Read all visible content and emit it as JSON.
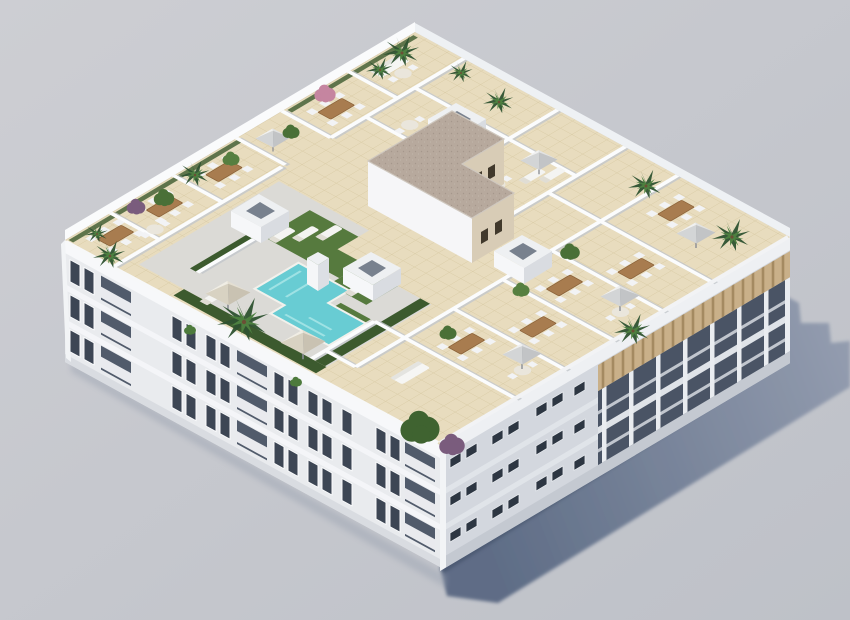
{
  "scene": {
    "title": "Aerial 3D architectural render of a white apartment block with a landscaped rooftop terrace and L-shaped swimming pool",
    "type": "3d-architectural-render",
    "view": "isometric aerial from above, sun from upper-left, long blue-grey shadow cast to the lower-right",
    "background": "plain light grey studio backdrop, no text or UI elements"
  },
  "palette": {
    "bg_top": "#cdced3",
    "bg_bottom": "#bec1c8",
    "shadow_near": "#54647f",
    "shadow_far": "#8e98ac",
    "facade_sunlit": "#e9ebee",
    "facade_shaded": "#d3d7de",
    "fascia": "#f7f8fa",
    "slab": "#f4f5f8",
    "window_dark": "#3d4654",
    "window_dark_shaded": "#2d3642",
    "balcony_recess": "#515b6b",
    "railing": "#f1f2f5",
    "pergola_wood": "#c9b089",
    "pergola_stripe": "#a48a61",
    "balcony_void": "#4a5465",
    "column_white": "#e9ecf0",
    "tile": "#e8dcbe",
    "tile_grout": "#d9cba5",
    "deck_concrete": "#dbdad6",
    "wall_white": "#fbfcfd",
    "parapet": "#fafbfc",
    "lawn": "#567a3e",
    "hedge": "#3c5a2e",
    "pool_water": "#68ccd3",
    "pool_ripple": "#9fe2e4",
    "coping": "#f2f1ec",
    "gravel_roof": "#b7a99d",
    "gravel_dot": "#a5978c",
    "penthouse_wall_shaded": "#d8ccb6",
    "wood_furniture": "#a87c4f",
    "chair_white": "#f2f3f5",
    "parasol_beige_light": "#efe9da",
    "parasol_beige_shade": "#c9c0ab",
    "parasol_gray_light": "#ededec",
    "parasol_gray_shade": "#c2c4c6",
    "palm_dark": "#2e5230",
    "palm_light": "#4d8040",
    "bush_green": "#4a7037",
    "tree_green": "#3f6330",
    "bush_purple": "#7a5c7d",
    "bush_pink": "#c585a0",
    "trunk": "#6b4f35"
  },
  "building": {
    "floors_below_roof": 3,
    "left_facade": "sunlit white, 11 bays per floor, mix of dark window pairs and recessed balconies with white railings",
    "right_facade": "shaded grey-white, small window pairs near the corner, open balcony galleries with wooden pergola slats toward the right corner",
    "shadow": "stepped building silhouette projected on the ground to the right"
  },
  "rooftop": {
    "surface": "beige tile grid with grey concrete pool deck",
    "pool": "L-shaped turquoise pool with white coping",
    "lawns": 4,
    "skylights": 4,
    "penthouse": "L-shaped stair/penthouse volume with taupe gravel roof and beige shaded walls",
    "parasols": 7,
    "terraces": "private terraces divided by low white walls with dining sets, loungers and sofas",
    "planting": "palms, green bushes, one purple and one pink flowering tree along the parapets"
  }
}
